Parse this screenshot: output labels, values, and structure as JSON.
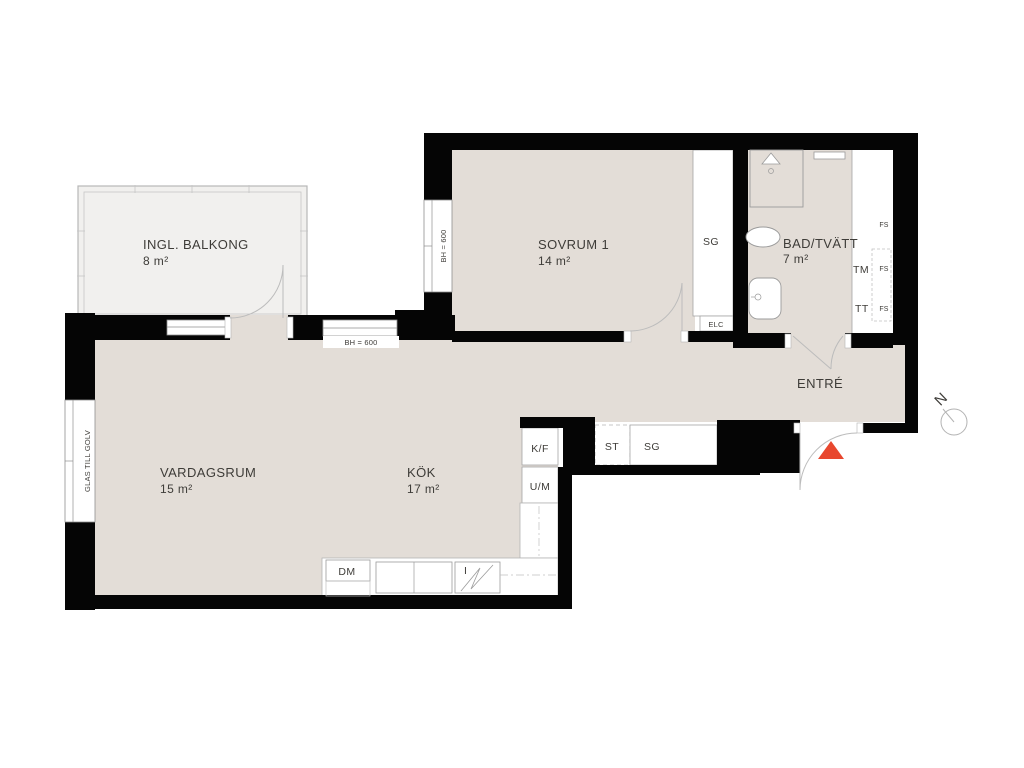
{
  "plan": {
    "rooms": {
      "balcony": {
        "name": "INGL. BALKONG",
        "area": "8 m²"
      },
      "bedroom": {
        "name": "SOVRUM 1",
        "area": "14 m²"
      },
      "bathroom": {
        "name": "BAD/TVÄTT",
        "area": "7 m²"
      },
      "living": {
        "name": "VARDAGSRUM",
        "area": "15 m²"
      },
      "kitchen": {
        "name": "KÖK",
        "area": "17 m²"
      },
      "entrance": {
        "name": "ENTRÉ"
      }
    },
    "fixtures": {
      "wardrobe_bedroom": "SG",
      "electrical_cabinet": "ELC",
      "washing_machine": "TM",
      "tumble_dryer": "TT",
      "linen_cupboard_1": "FS",
      "linen_cupboard_2": "FS",
      "linen_cupboard_3": "FS",
      "fridge_freezer": "K/F",
      "oven_microwave": "U/M",
      "cleaning_closet": "ST",
      "wardrobe_hall": "SG",
      "dishwasher": "DM",
      "hob": "I"
    },
    "annotations": {
      "sill_height_living": "BH = 600",
      "sill_height_bedroom": "BH = 600",
      "glass_to_floor": "GLAS TILL GOLV",
      "north": "N"
    },
    "colors": {
      "floor": "#e3ddd7",
      "balcony_floor": "#f1f0ee",
      "wall": "#050505",
      "entry_marker": "#e8472e"
    }
  }
}
